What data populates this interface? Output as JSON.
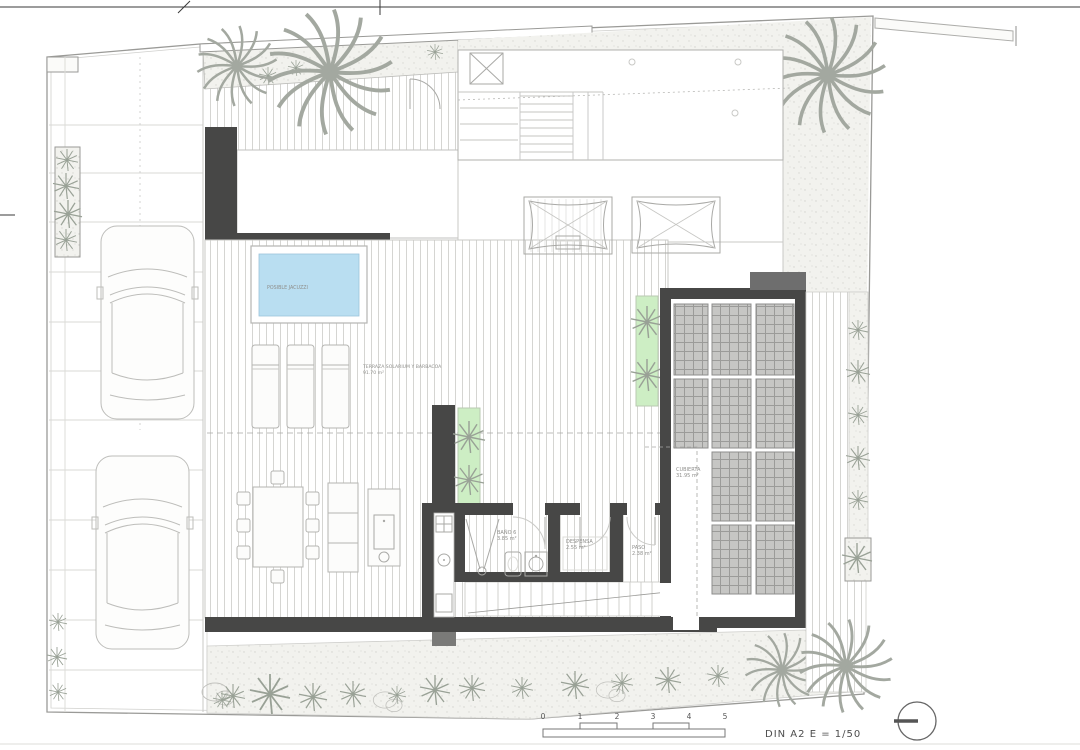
{
  "sheet": {
    "note": "DIN A2  E = 1/50",
    "scale_ticks": [
      "0",
      "1",
      "2",
      "3",
      "4",
      "5"
    ]
  },
  "rooms": {
    "jacuzzi": {
      "label": "POSIBLE JACUZZI"
    },
    "terrace": {
      "name": "TERRAZA SOLARIUM Y BARBACOA",
      "area": "91.70 m²"
    },
    "cubierta": {
      "name": "CUBIERTA",
      "area": "31.95 m²"
    },
    "bano": {
      "name": "BAÑO 6",
      "area": "3.85 m²"
    },
    "despensa": {
      "name": "DESPENSA",
      "area": "2.55 m²"
    },
    "paso": {
      "name": "PASO",
      "area": "2.38 m²"
    }
  },
  "colors": {
    "pool": "#b9def1",
    "green": "#cdeec4",
    "wall": "#474746",
    "panel": "#c6c6c4",
    "ground": "#f2f2ee"
  }
}
